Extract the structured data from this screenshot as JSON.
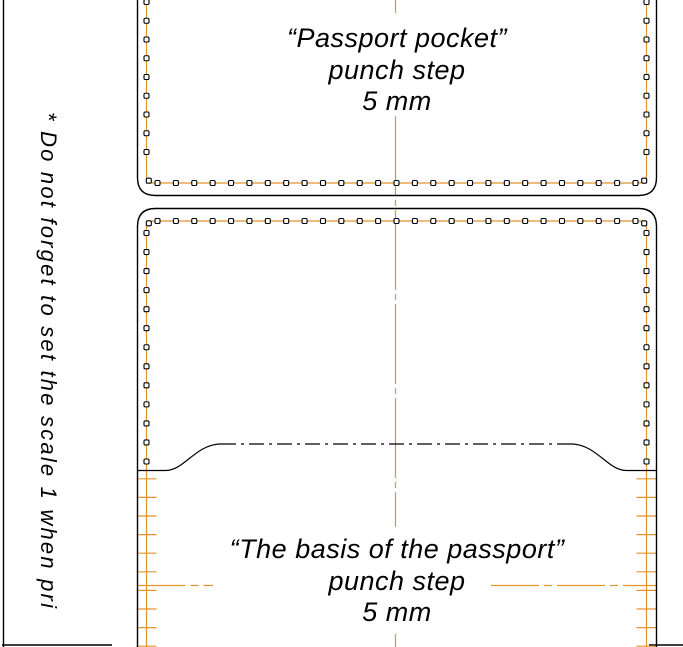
{
  "colors": {
    "orange": "#E2952D",
    "ink": "#000000",
    "bg": "#FFFFFF"
  },
  "scale_note": "* Do not forget to set the scale 1 when pri",
  "pieces": {
    "top": {
      "title": "“Passport pocket”",
      "line2": "punch step",
      "line3": "5 mm"
    },
    "bottom": {
      "title": "“The basis of the passport”",
      "line2": "punch step",
      "line3": "5 mm"
    }
  },
  "pattern": {
    "punch_step": 18.6,
    "hole_size": 5,
    "stitch_left": 146.5,
    "stitch_right": 646.5,
    "row_x0": 157.5,
    "row_x1": 635.5,
    "top": {
      "col_y0": 2,
      "col_y1": 152,
      "row_y": 183,
      "corner_y": 180.7
    },
    "bot": {
      "row_y": 221,
      "corner_y": 223.3,
      "col_y0": 233,
      "col_y1": 461.5,
      "col_step": 19.05,
      "tick_y0": 478.8,
      "tick_end": 647,
      "tick_halfwidth": 10
    }
  }
}
